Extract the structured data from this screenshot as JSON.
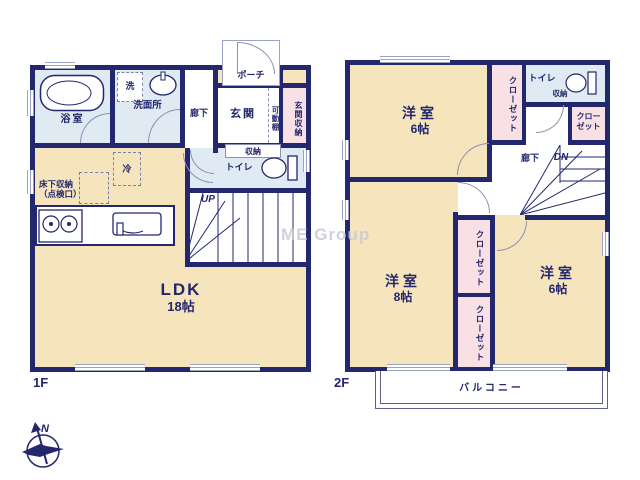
{
  "watermark": "ME Group",
  "compass": {
    "north": "N"
  },
  "floor1": {
    "name": "1F",
    "labels": {
      "bath": "浴室",
      "washer": "洗",
      "washroom": "洗面所",
      "hallway": "廊下",
      "porch": "ポーチ",
      "entrance": "玄関",
      "movable_shelf": "可動棚",
      "entrance_storage": "玄関収納",
      "storage": "収納",
      "toilet": "トイレ",
      "stairs_up": "UP",
      "fridge": "冷",
      "underfloor_storage": "床下収納",
      "underfloor_storage_sub": "（点検口）",
      "ldk": "LDK",
      "ldk_size": "18帖"
    }
  },
  "floor2": {
    "name": "2F",
    "labels": {
      "bedroom_top": "洋室",
      "bedroom_top_size": "6帖",
      "closet": "クローゼット",
      "toilet": "トイレ",
      "storage": "収納",
      "hallway": "廊下",
      "stairs_down": "DN",
      "bedroom_left": "洋室",
      "bedroom_left_size": "8帖",
      "bedroom_right": "洋室",
      "bedroom_right_size": "6帖",
      "balcony": "バルコニー"
    }
  },
  "colors": {
    "wall": "#23276e",
    "room_tan": "#f6e4bc",
    "wet_blue": "#dfeaf2",
    "closet_pink": "#f8e0e4",
    "window_gray": "#9aa3c4",
    "text_navy": "#23276e",
    "watermark_gray": "#c9cad3"
  }
}
